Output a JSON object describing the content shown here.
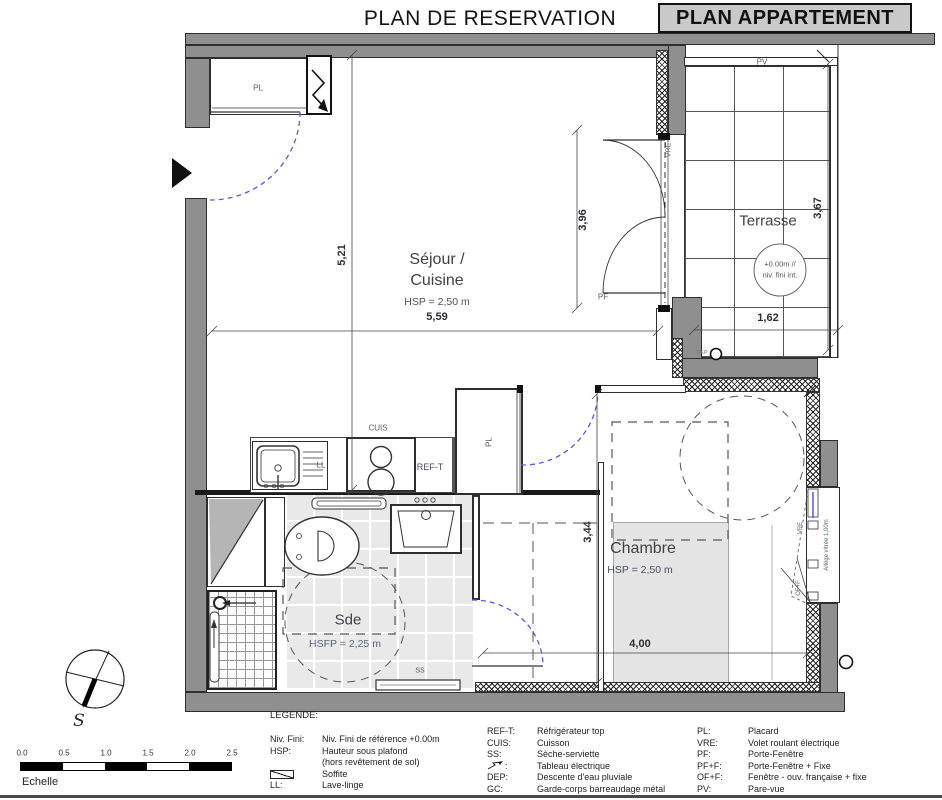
{
  "header": {
    "title": "PLAN DE RESERVATION",
    "badge": "PLAN APPARTEMENT"
  },
  "rooms": {
    "sejour": {
      "line1": "Séjour /",
      "line2": "Cuisine",
      "hsp": "HSP = 2,50 m"
    },
    "chambre": {
      "name": "Chambre",
      "hsp": "HSP = 2,50 m"
    },
    "sde": {
      "name": "Sde",
      "hsp": "HSFP = 2,25 m"
    },
    "terrasse": {
      "name": "Terrasse",
      "level1": "+0.00m //",
      "level2": "niv. fini int."
    }
  },
  "dims": {
    "sejour_w": "5,59",
    "sejour_h": "5,21",
    "pf_h": "3,96",
    "terrasse_h": "3,67",
    "terrasse_w": "1,62",
    "chambre_h": "3,44",
    "chambre_w": "4,00"
  },
  "tags": {
    "pl": "PL",
    "pv": "PV",
    "vre": "VRE",
    "pf": "PF",
    "cuis": "CUIS",
    "ref_t": "REF-T",
    "ll": "LL",
    "ss": "SS",
    "dep": "DEP",
    "of_f": "OF+F",
    "allege": "Allège vitrée 1,00m"
  },
  "compass": {
    "south": "S"
  },
  "scalebar": {
    "ticks": [
      "0.0",
      "0.5",
      "1.0",
      "1.5",
      "2.0",
      "2.5"
    ],
    "label": "Echelle"
  },
  "legend": {
    "title": "LEGENDE:",
    "col1": [
      {
        "term": "Niv. Fini:",
        "def": "Niv. Fini de référence +0.00m"
      },
      {
        "term": "HSP:",
        "def": "Hauteur sous plafond"
      },
      {
        "term": "",
        "def": "(hors revêtement de sol)"
      },
      {
        "term": "",
        "def": "Soffite"
      },
      {
        "term": "LL:",
        "def": "Lave-linge"
      }
    ],
    "col2": [
      {
        "term": "REF-T:",
        "def": "Réfrigérateur top"
      },
      {
        "term": "CUIS:",
        "def": "Cuisson"
      },
      {
        "term": "SS:",
        "def": "Sèche-serviette"
      },
      {
        "term": ":",
        "def": "Tableau électrique"
      },
      {
        "term": "DEP:",
        "def": "Descente d'eau pluviale"
      },
      {
        "term": "GC:",
        "def": "Garde-corps barreaudage métal"
      }
    ],
    "col3": [
      {
        "term": "PL:",
        "def": "Placard"
      },
      {
        "term": "VRE:",
        "def": "Volet roulant électrique"
      },
      {
        "term": "PF:",
        "def": "Porte-Fenêtre"
      },
      {
        "term": "PF+F:",
        "def": "Porte-Fenêtre + Fixe"
      },
      {
        "term": "OF+F:",
        "def": "Fenêtre - ouv. française + fixe"
      },
      {
        "term": "PV:",
        "def": "Pare-vue"
      }
    ]
  }
}
